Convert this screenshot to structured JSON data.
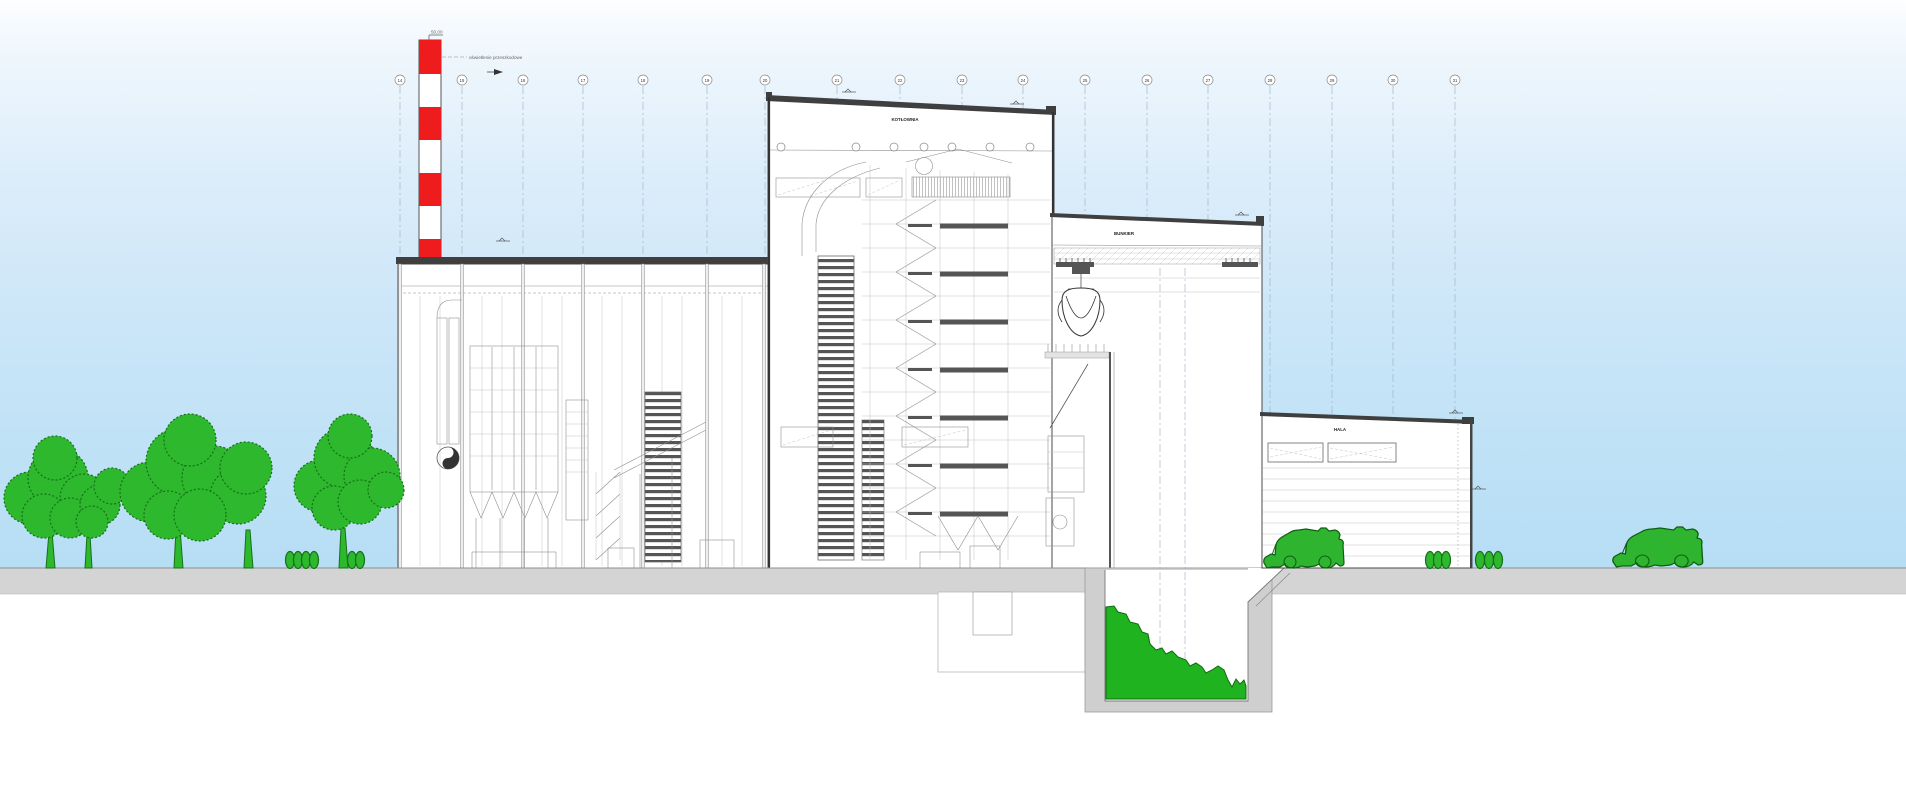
{
  "annotations": {
    "obstacle_light_label": "oświetlenie przeszkodowe",
    "chimney_top_elevation": "50,00"
  },
  "buildings": {
    "boiler_house": {
      "label": "KOTŁOWNIA"
    },
    "bunker_hall": {
      "label": "BUNKIER"
    },
    "unloading_hall": {
      "label": "HALA"
    }
  },
  "grid": {
    "axes": [
      "14",
      "15",
      "16",
      "17",
      "18",
      "19",
      "20",
      "21",
      "22",
      "23",
      "24",
      "25",
      "26",
      "27",
      "28",
      "29",
      "30",
      "31"
    ]
  },
  "colors": {
    "chimney_red": "#ee1c1c",
    "vegetation_green": "#2db82d",
    "waste_green": "#1fb41f",
    "vehicle_green": "#2fb42f",
    "ground_gray": "#d4d4d4",
    "sky_blue": "#b6def5",
    "roof_dark": "#3f3f3f"
  }
}
